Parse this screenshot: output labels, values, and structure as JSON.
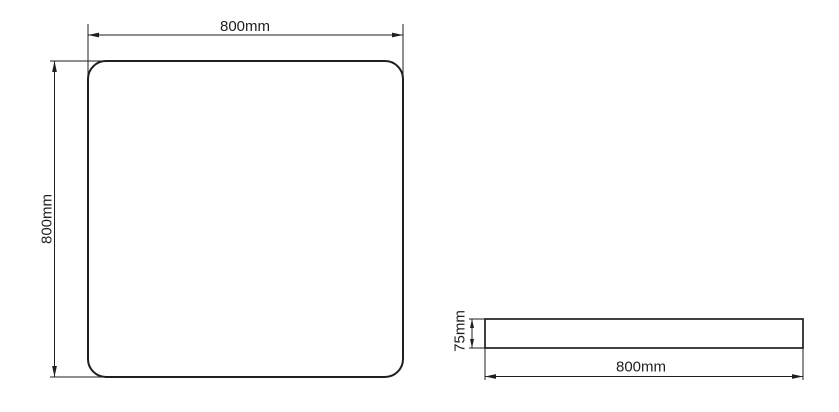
{
  "page": {
    "background_color": "#ffffff"
  },
  "colors": {
    "line": "#1f1f1f"
  },
  "drawing": {
    "front_view": {
      "width_label": "800mm",
      "height_label": "800mm"
    },
    "side_view": {
      "height_label": "75mm",
      "width_label": "800mm"
    }
  }
}
